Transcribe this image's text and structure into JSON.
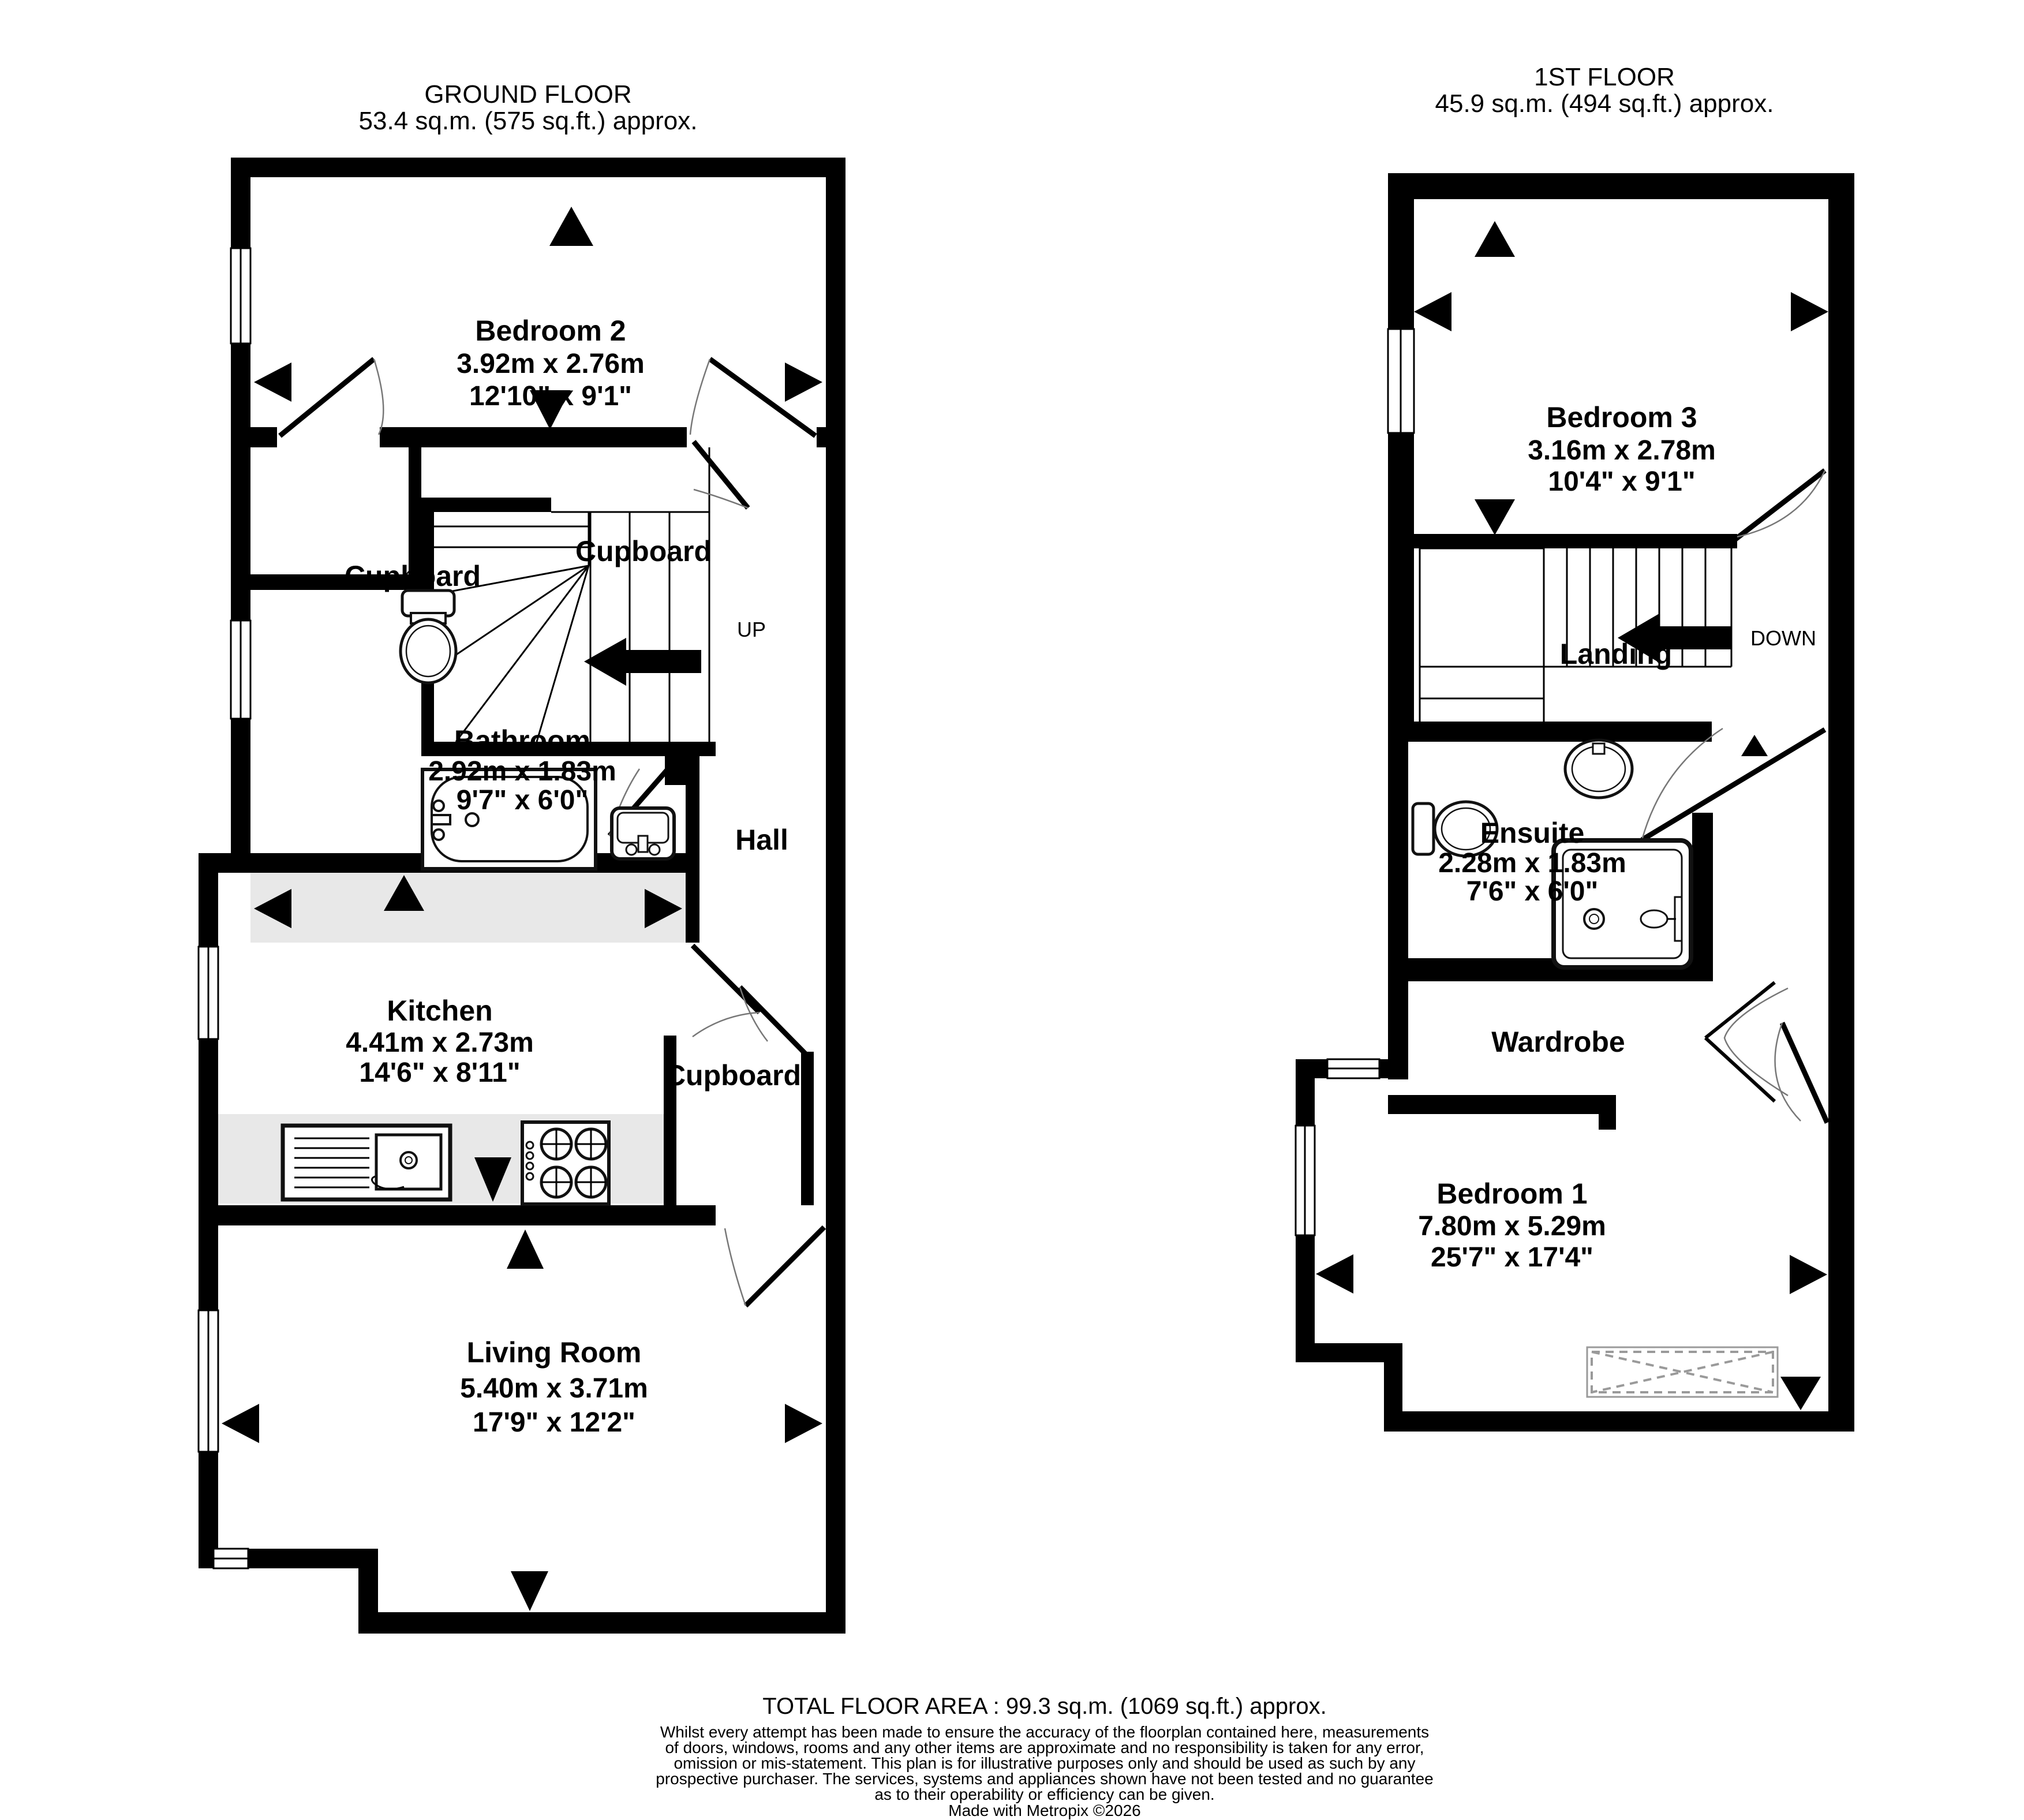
{
  "ground": {
    "title": "GROUND FLOOR",
    "area": "53.4 sq.m. (575 sq.ft.) approx.",
    "bedroom2": {
      "name": "Bedroom 2",
      "metric": "3.92m  x 2.76m",
      "imperial": "12'10\"  x 9'1\""
    },
    "bathroom": {
      "name": "Bathroom",
      "metric": "2.92m  x 1.83m",
      "imperial": "9'7\"  x 6'0\""
    },
    "kitchen": {
      "name": "Kitchen",
      "metric": "4.41m  x 2.73m",
      "imperial": "14'6\"  x 8'11\""
    },
    "living": {
      "name": "Living Room",
      "metric": "5.40m  x 3.71m",
      "imperial": "17'9\"  x 12'2\""
    },
    "hall": {
      "name": "Hall"
    },
    "cupboard_left": {
      "label": "Cupboard"
    },
    "cupboard_top": {
      "label": "Cupboard"
    },
    "cupboard_lower": {
      "label": "Cupboard"
    },
    "up_label": "UP"
  },
  "first": {
    "title": "1ST FLOOR",
    "area": "45.9 sq.m. (494 sq.ft.) approx.",
    "bedroom3": {
      "name": "Bedroom 3",
      "metric": "3.16m  x 2.78m",
      "imperial": "10'4\"  x 9'1\""
    },
    "landing": {
      "name": "Landing"
    },
    "down_label": "DOWN",
    "ensuite": {
      "name": "Ensuite",
      "metric": "2.28m  x 1.83m",
      "imperial": "7'6\"  x 6'0\""
    },
    "wardrobe": {
      "label": "Wardrobe"
    },
    "bedroom1": {
      "name": "Bedroom 1",
      "metric": "7.80m  x 5.29m",
      "imperial": "25'7\"  x 17'4\""
    }
  },
  "footer": {
    "total": "TOTAL FLOOR AREA : 99.3 sq.m. (1069 sq.ft.) approx.",
    "disclaimer": [
      "Whilst every attempt has been made to ensure the accuracy of the floorplan contained here, measurements",
      "of doors, windows, rooms and any other items are approximate and no responsibility is taken for any error,",
      "omission or mis-statement. This plan is for illustrative purposes only and should be used as such by any",
      "prospective purchaser. The services, systems and appliances shown have not been tested and no guarantee",
      "as to their operability or efficiency can be given."
    ],
    "credit": "Made with Metropix ©2026"
  }
}
